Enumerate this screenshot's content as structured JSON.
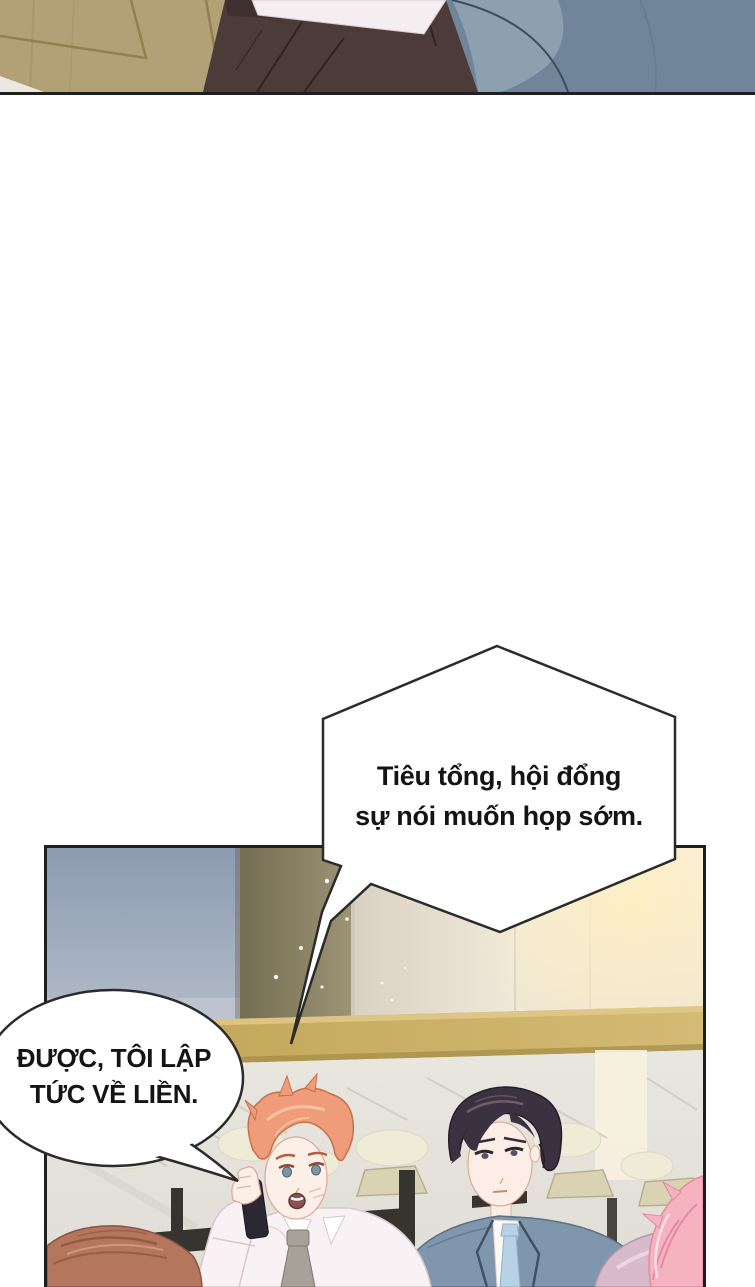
{
  "page": {
    "kind": "comic-page",
    "background": "#ffffff"
  },
  "speech_bubbles": {
    "hexagon": {
      "shape": "hexagon",
      "tail": "long-spike-to-lower-left",
      "line1": "Tiêu tổng, hội đổng",
      "line2": "sự nói muốn họp sớm."
    },
    "oval": {
      "shape": "ellipse",
      "tail": "short-point-to-lower-right",
      "line1": "ĐƯỢC, TÔI LẬP",
      "line2": "TỨC VỀ LIỀN."
    }
  },
  "colors": {
    "page_background": "#ffffff",
    "panel_border": "#1f1f1f",
    "bubble_fill": "#ffffff",
    "bubble_stroke": "#2b2b2b",
    "bubble_text": "#141414",
    "wood_wall": "#b2a077",
    "trousers_top_panel": "#4c3b39",
    "shirt_top_panel": "#f4eef0",
    "suit_top_panel": "#71859a",
    "window_blue": "#8c9bb1",
    "olive_wall": "#8a8065",
    "pale_wall": "#e4ddcd",
    "cream_wall": "#f4ecda",
    "counter_gold": "#c8ab60",
    "marble": "#e6e4dd",
    "stool_seat": "#d9d3b3",
    "stool_post": "#35342e",
    "orange_hair": "#ee9c79",
    "orange_man_tie": "#a7a19a",
    "phone": "#2c2833",
    "dark_hair": "#3a3240",
    "dark_man_suit": "#8096ac",
    "dark_man_tie": "#b7d2e4",
    "auburn_hair": "#b4765c",
    "pink_hair": "#f5b3c0",
    "pink_shoulder": "#d9bacb"
  }
}
